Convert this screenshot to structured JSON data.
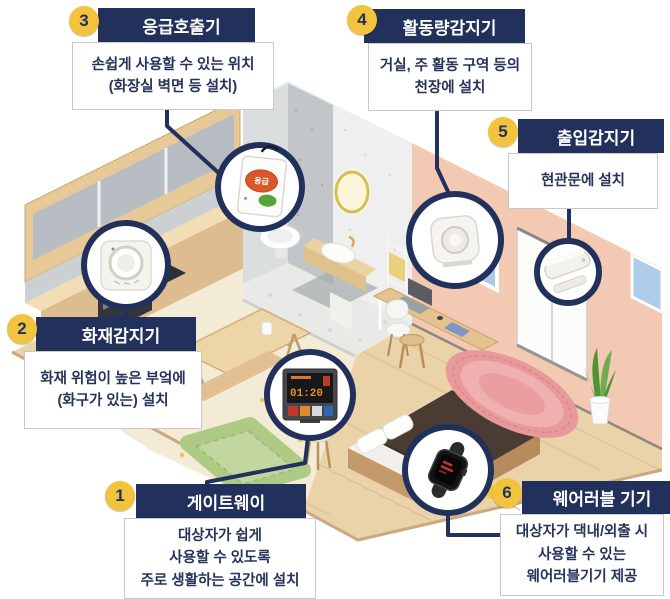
{
  "colors": {
    "navy": "#22315c",
    "badge_yellow": "#f2c33c",
    "body_text": "#26335a",
    "box_border": "#c9c9c9",
    "connector": "#22315c",
    "circle_fill": "#ffffff"
  },
  "callouts": [
    {
      "number": "1",
      "title": "게이트웨이",
      "icon": "gateway-device-icon",
      "lines": [
        "대상자가 쉽게",
        "사용할 수 있도록",
        "주로 생활하는 공간에 설치"
      ]
    },
    {
      "number": "2",
      "title": "화재감지기",
      "icon": "fire-detector-icon",
      "lines": [
        "화재 위험이 높은 부엌에",
        "(화구가 있는) 설치"
      ]
    },
    {
      "number": "3",
      "title": "응급호출기",
      "icon": "emergency-call-button-icon",
      "lines": [
        "손쉽게 사용할 수 있는 위치",
        "(화장실 벽면 등 설치)"
      ]
    },
    {
      "number": "4",
      "title": "활동량감지기",
      "icon": "activity-sensor-icon",
      "lines": [
        "거실, 주 활동 구역 등의",
        "천장에 설치"
      ]
    },
    {
      "number": "5",
      "title": "출입감지기",
      "icon": "entry-sensor-icon",
      "lines": [
        "현관문에 설치"
      ]
    },
    {
      "number": "6",
      "title": "웨어러블 기기",
      "icon": "wearable-watch-icon",
      "lines": [
        "대상자가 댁내/외출 시",
        "사용할 수 있는",
        "웨어러블기기 제공"
      ]
    }
  ],
  "gateway": {
    "screen_time": "01:20"
  },
  "emergency": {
    "button_label": "응급"
  },
  "room_elements": [
    "kitchen-cabinets",
    "oven",
    "dining-table",
    "bench",
    "stools",
    "green-rug",
    "bathroom",
    "toilet",
    "sink",
    "round-mirror",
    "towel-rack",
    "desk",
    "laptop",
    "chair",
    "sliding-door",
    "window",
    "wall-clock",
    "pink-rug",
    "bed",
    "pillows",
    "potted-plant",
    "yellow-ball"
  ]
}
